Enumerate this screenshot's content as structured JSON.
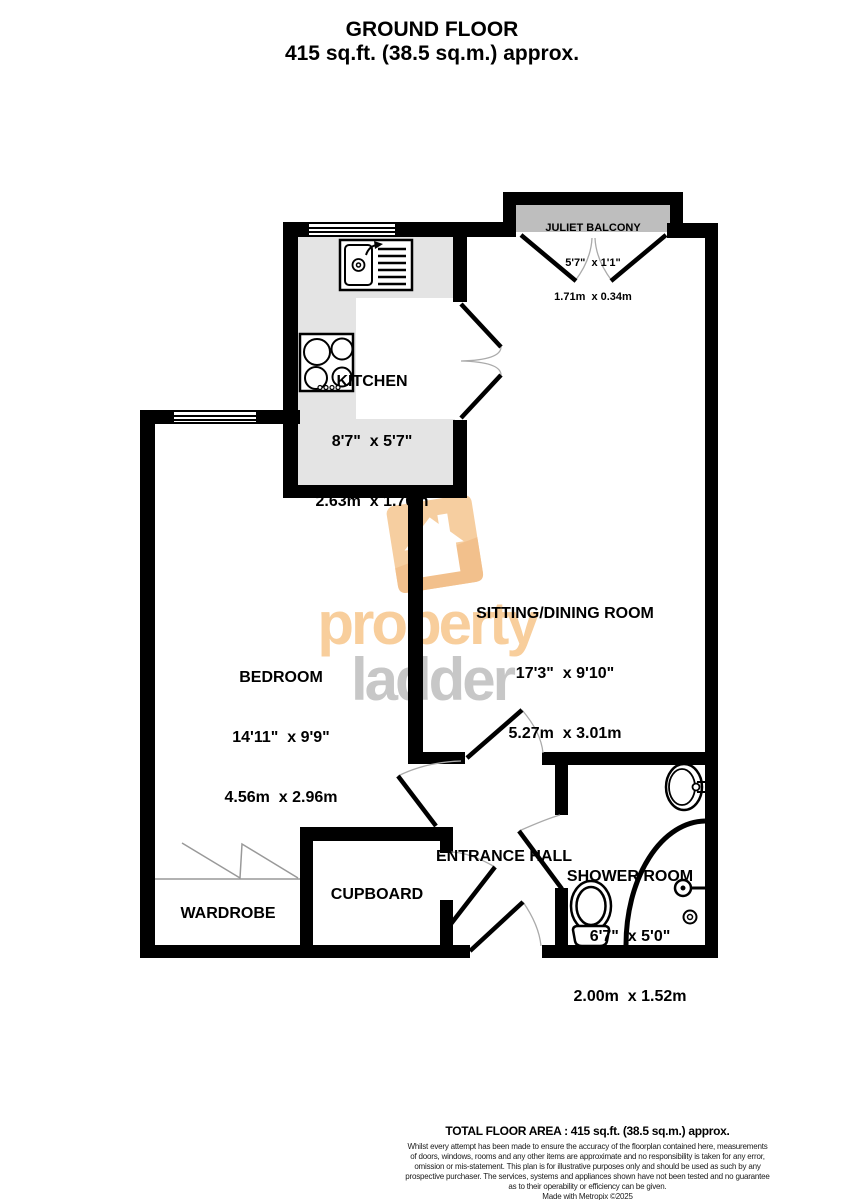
{
  "title": {
    "line1": "GROUND FLOOR",
    "line2": "415 sq.ft. (38.5 sq.m.) approx."
  },
  "watermark": {
    "word_top": "property",
    "word_bottom": "ladder"
  },
  "rooms": {
    "balcony": {
      "name": "JULIET BALCONY",
      "imperial": "5'7\"  x 1'1\"",
      "metric": "1.71m  x 0.34m"
    },
    "kitchen": {
      "name": "KITCHEN",
      "imperial": "8'7\"  x 5'7\"",
      "metric": "2.63m  x 1.70m"
    },
    "sitting": {
      "name": "SITTING/DINING ROOM",
      "imperial": "17'3\"  x 9'10\"",
      "metric": "5.27m  x 3.01m"
    },
    "bedroom": {
      "name": "BEDROOM",
      "imperial": "14'11\"  x 9'9\"",
      "metric": "4.56m  x 2.96m"
    },
    "shower": {
      "name": "SHOWER ROOM",
      "imperial": "6'7\"  x 5'0\"",
      "metric": "2.00m  x 1.52m"
    },
    "entrance": {
      "name": "ENTRANCE HALL"
    },
    "cupboard": {
      "name": "CUPBOARD"
    },
    "wardrobe": {
      "name": "WARDROBE"
    }
  },
  "footer": {
    "total": "TOTAL FLOOR AREA : 415 sq.ft. (38.5 sq.m.) approx.",
    "disclaimer_lines": [
      "Whilst every attempt has been made to ensure the accuracy of the floorplan contained here, measurements",
      "of doors, windows, rooms and any other items are approximate and no responsibility is taken for any error,",
      "omission or mis-statement. This plan is for illustrative purposes only and should be used as such by any",
      "prospective purchaser. The services, systems and appliances shown have not been tested and no guarantee",
      "as to their operability or efficiency can be given."
    ],
    "credit": "Made with Metropix ©2025"
  },
  "colors": {
    "wall": "#000000",
    "kitchen_floor": "#E4E4E4",
    "balcony_floor": "#BEBEBE",
    "watermark_orange": "#F8CE9C",
    "watermark_gray": "#C7C7C7"
  }
}
